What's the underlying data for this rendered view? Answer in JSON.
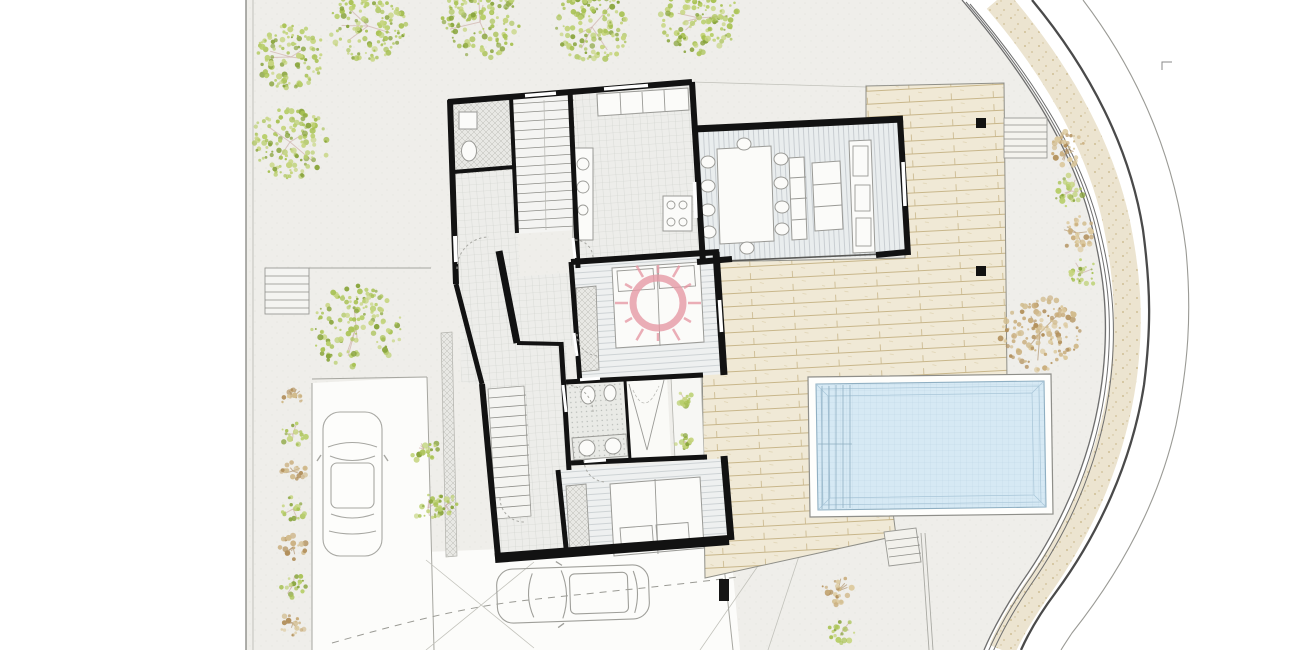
{
  "title": "villa-site-plan-drawing",
  "colors": {
    "wall": "#121212",
    "ground": "#efeeea",
    "furniture_stroke": "#9a9a96",
    "deck_base": "#f0e9d6",
    "deck_plank": "#c8b68a",
    "pool_water": "#d6e9f4",
    "pool_grid": "#bcd6e4",
    "pool_edge": "#8fafc2",
    "road_speckle_bg": "#ece4d0",
    "road_speckle_dot": "#d0bf96",
    "curb_line": "#6e6e6e",
    "road_main_line": "#4a4a4a",
    "sun_pink": "#e79aa6",
    "green_palette": [
      "#a9c255",
      "#c6d57f",
      "#8aa53e",
      "#b9cf6d"
    ],
    "tan_palette": [
      "#c9ad7c",
      "#dcc99e",
      "#b2905c",
      "#d1bb8d"
    ],
    "branch_green_tree": "#c9a9a2",
    "branch_tan_tree": "#a8885f"
  },
  "vegetation": {
    "trees": [
      {
        "x": 291,
        "y": 57,
        "r": 37,
        "type": "green"
      },
      {
        "x": 368,
        "y": 26,
        "r": 40,
        "type": "green"
      },
      {
        "x": 480,
        "y": 22,
        "r": 42,
        "type": "green"
      },
      {
        "x": 592,
        "y": 27,
        "r": 40,
        "type": "green"
      },
      {
        "x": 699,
        "y": 18,
        "r": 42,
        "type": "green"
      },
      {
        "x": 290,
        "y": 142,
        "r": 41,
        "type": "green"
      },
      {
        "x": 356,
        "y": 327,
        "r": 48,
        "type": "green"
      },
      {
        "x": 1040,
        "y": 333,
        "r": 42,
        "type": "tan"
      }
    ],
    "shrubs": [
      {
        "x": 293,
        "y": 397,
        "r": 14,
        "type": "tan"
      },
      {
        "x": 293,
        "y": 434,
        "r": 14,
        "type": "green"
      },
      {
        "x": 293,
        "y": 471,
        "r": 14,
        "type": "tan"
      },
      {
        "x": 293,
        "y": 509,
        "r": 14,
        "type": "green"
      },
      {
        "x": 293,
        "y": 547,
        "r": 14,
        "type": "tan"
      },
      {
        "x": 293,
        "y": 585,
        "r": 14,
        "type": "green"
      },
      {
        "x": 293,
        "y": 623,
        "r": 14,
        "type": "tan"
      },
      {
        "x": 424,
        "y": 449,
        "r": 15,
        "type": "green"
      },
      {
        "x": 428,
        "y": 508,
        "r": 16,
        "type": "green"
      },
      {
        "x": 446,
        "y": 505,
        "r": 12,
        "type": "green"
      },
      {
        "x": 684,
        "y": 399,
        "r": 9,
        "type": "green"
      },
      {
        "x": 683,
        "y": 441,
        "r": 9,
        "type": "green"
      },
      {
        "x": 1067,
        "y": 149,
        "r": 20,
        "type": "tan"
      },
      {
        "x": 1071,
        "y": 191,
        "r": 18,
        "type": "green"
      },
      {
        "x": 1077,
        "y": 233,
        "r": 20,
        "type": "tan"
      },
      {
        "x": 1082,
        "y": 273,
        "r": 17,
        "type": "green"
      },
      {
        "x": 838,
        "y": 591,
        "r": 17,
        "type": "tan"
      },
      {
        "x": 843,
        "y": 630,
        "r": 15,
        "type": "green"
      }
    ]
  },
  "deck_posts": [
    {
      "x": 981,
      "y": 123
    },
    {
      "x": 981,
      "y": 271
    }
  ],
  "pool": {
    "step_lines": 5,
    "inner_offsets": [
      5,
      12
    ]
  },
  "sun_watermark": {
    "x": 658,
    "y": 303,
    "ring_radius": 25,
    "rays": 12
  },
  "cars": [
    {
      "id": "car-top-view-parked",
      "view": "top",
      "x": 323,
      "y": 412
    },
    {
      "id": "car-top-view-driveway",
      "view": "top",
      "x": 497,
      "y": 567
    }
  ],
  "dining": {
    "chairs": 10
  },
  "beds": 2
}
